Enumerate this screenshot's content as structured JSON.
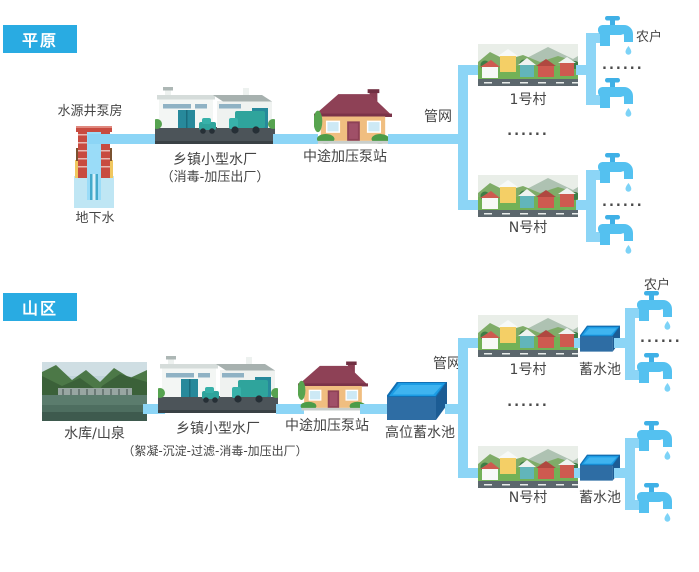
{
  "colors": {
    "badge_bg": "#29ABE2",
    "pipe": "#8CD5F6",
    "faucet": "#54C1F0"
  },
  "plain": {
    "badge": "平原",
    "well_pump_label": "水源井泵房",
    "groundwater_label": "地下水",
    "plant_label": "乡镇小型水厂",
    "plant_process": "（消毒-加压出厂）",
    "booster_label": "中途加压泵站",
    "pipe_network_label": "管网",
    "village_1_label": "1号村",
    "village_n_label": "N号村",
    "household_label": "农户",
    "ellipsis": "......"
  },
  "mountain": {
    "badge": "山区",
    "source_label": "水库/山泉",
    "plant_label": "乡镇小型水厂",
    "plant_process": "（絮凝-沉淀-过滤-消毒-加压出厂）",
    "booster_label": "中途加压泵站",
    "high_tank_label": "高位蓄水池",
    "pipe_network_label": "管网",
    "village_1_label": "1号村",
    "village_n_label": "N号村",
    "village_tank_label": "蓄水池",
    "household_label": "农户",
    "ellipsis": "......"
  }
}
